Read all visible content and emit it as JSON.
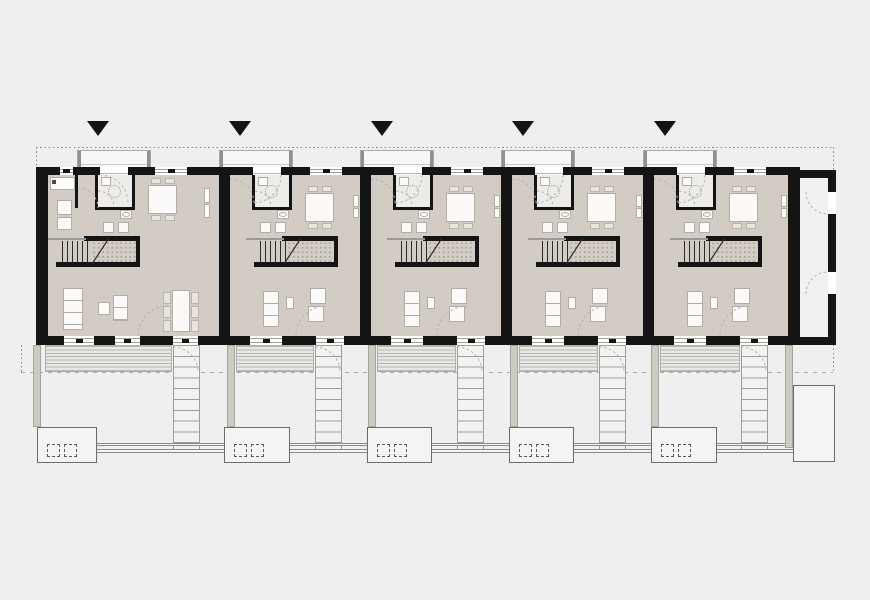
{
  "plan": {
    "description": "Floor plan of a row of five terraced houses with entrance markers, interior furnishing, rear terraces, garden stairs, hedges and storage sheds",
    "colors": {
      "background": "#efeff0",
      "wall": "#141414",
      "floor": "#d3ccc5",
      "wc_floor": "#eeece9",
      "deck": "#e7e7e4",
      "hedge": "#c9ccc1",
      "marker": "#131313",
      "line_gray": "#8c8c8c",
      "furniture_border": "#b3ada6"
    },
    "canvas": {
      "width": 870,
      "height": 600
    },
    "markers": [
      98,
      240,
      382,
      523,
      665
    ],
    "marker_top": 121,
    "boundary": {
      "top": [
        36,
        147,
        797
      ],
      "right_v": [
        833,
        147,
        226
      ],
      "left_top_v": [
        36,
        147,
        20
      ],
      "left_low_v": [
        21,
        345,
        28
      ],
      "garden_dash": [
        21,
        372,
        812
      ]
    },
    "walls": {
      "top": [
        36,
        167,
        764,
        8
      ],
      "bottom": [
        36,
        336,
        764,
        9
      ],
      "left": [
        36,
        167,
        12,
        178
      ],
      "right": [
        788,
        167,
        12,
        178
      ],
      "party": [
        [
          219,
          167,
          11,
          178
        ],
        [
          360,
          167,
          11,
          178
        ],
        [
          501,
          167,
          11,
          178
        ],
        [
          643,
          167,
          11,
          178
        ]
      ]
    },
    "annex": {
      "interior": [
        800,
        178,
        28,
        159
      ],
      "top": [
        800,
        170,
        36,
        8
      ],
      "right": [
        828,
        178,
        8,
        159
      ],
      "bottom": [
        800,
        337,
        36,
        8
      ],
      "door_gaps": [
        [
          192,
          22
        ],
        [
          272,
          22
        ]
      ]
    },
    "units": [
      {
        "id": "unit-1",
        "x": 48,
        "w": 171,
        "variant": "end_left",
        "porch": [
          77,
          74
        ],
        "top_openings": [
          [
            60,
            13,
            "window"
          ],
          [
            100,
            28,
            "entry"
          ],
          [
            155,
            32,
            "window"
          ]
        ],
        "bottom_openings": [
          [
            64,
            30
          ],
          [
            115,
            25
          ],
          [
            173,
            25
          ]
        ],
        "terrace": [
          45,
          127
        ],
        "garden_stairs_x": 173,
        "hedge_x": 33,
        "shed": [
          37,
          60
        ]
      },
      {
        "id": "unit-2",
        "x": 230,
        "w": 130,
        "variant": "typical",
        "porch": [
          219,
          74
        ],
        "top_openings": [
          [
            253,
            28,
            "entry"
          ],
          [
            310,
            32,
            "window"
          ]
        ],
        "bottom_openings": [
          [
            250,
            32
          ],
          [
            316,
            28
          ]
        ],
        "terrace": [
          236,
          78
        ],
        "garden_stairs_x": 315,
        "hedge_x": 227,
        "shed": [
          224,
          66
        ]
      },
      {
        "id": "unit-3",
        "x": 371,
        "w": 130,
        "variant": "typical",
        "porch": [
          360,
          74
        ],
        "top_openings": [
          [
            394,
            28,
            "entry"
          ],
          [
            451,
            32,
            "window"
          ]
        ],
        "bottom_openings": [
          [
            391,
            32
          ],
          [
            457,
            28
          ]
        ],
        "terrace": [
          377,
          79
        ],
        "garden_stairs_x": 457,
        "hedge_x": 368,
        "shed": [
          367,
          65
        ]
      },
      {
        "id": "unit-4",
        "x": 512,
        "w": 131,
        "variant": "typical",
        "porch": [
          501,
          74
        ],
        "top_openings": [
          [
            535,
            28,
            "entry"
          ],
          [
            592,
            32,
            "window"
          ]
        ],
        "bottom_openings": [
          [
            532,
            32
          ],
          [
            598,
            28
          ]
        ],
        "terrace": [
          519,
          79
        ],
        "garden_stairs_x": 599,
        "hedge_x": 510,
        "shed": [
          509,
          65
        ]
      },
      {
        "id": "unit-5",
        "x": 654,
        "w": 134,
        "variant": "typical",
        "porch": [
          643,
          74
        ],
        "top_openings": [
          [
            677,
            28,
            "entry"
          ],
          [
            734,
            32,
            "window"
          ]
        ],
        "bottom_openings": [
          [
            674,
            32
          ],
          [
            740,
            28
          ]
        ],
        "terrace": [
          660,
          80
        ],
        "garden_stairs_x": 741,
        "hedge_x": 651,
        "shed": [
          651,
          66
        ]
      }
    ],
    "garden": {
      "deck_y": 345,
      "deck_h": 27,
      "stairs_y": 345,
      "stairs_h": 108,
      "stairs_w": 27,
      "hedge_y": 345,
      "hedge_h": 82,
      "shed_y": 427,
      "shed_h": 36,
      "fence_segments": [
        [
          97,
          127
        ],
        [
          290,
          77
        ],
        [
          432,
          77
        ],
        [
          574,
          77
        ],
        [
          717,
          76
        ]
      ],
      "fence_y1": 443,
      "fence_y2": 449,
      "extra_hedge": [
        785,
        345,
        8,
        103
      ],
      "big_shed": [
        793,
        385,
        42,
        77
      ]
    }
  }
}
